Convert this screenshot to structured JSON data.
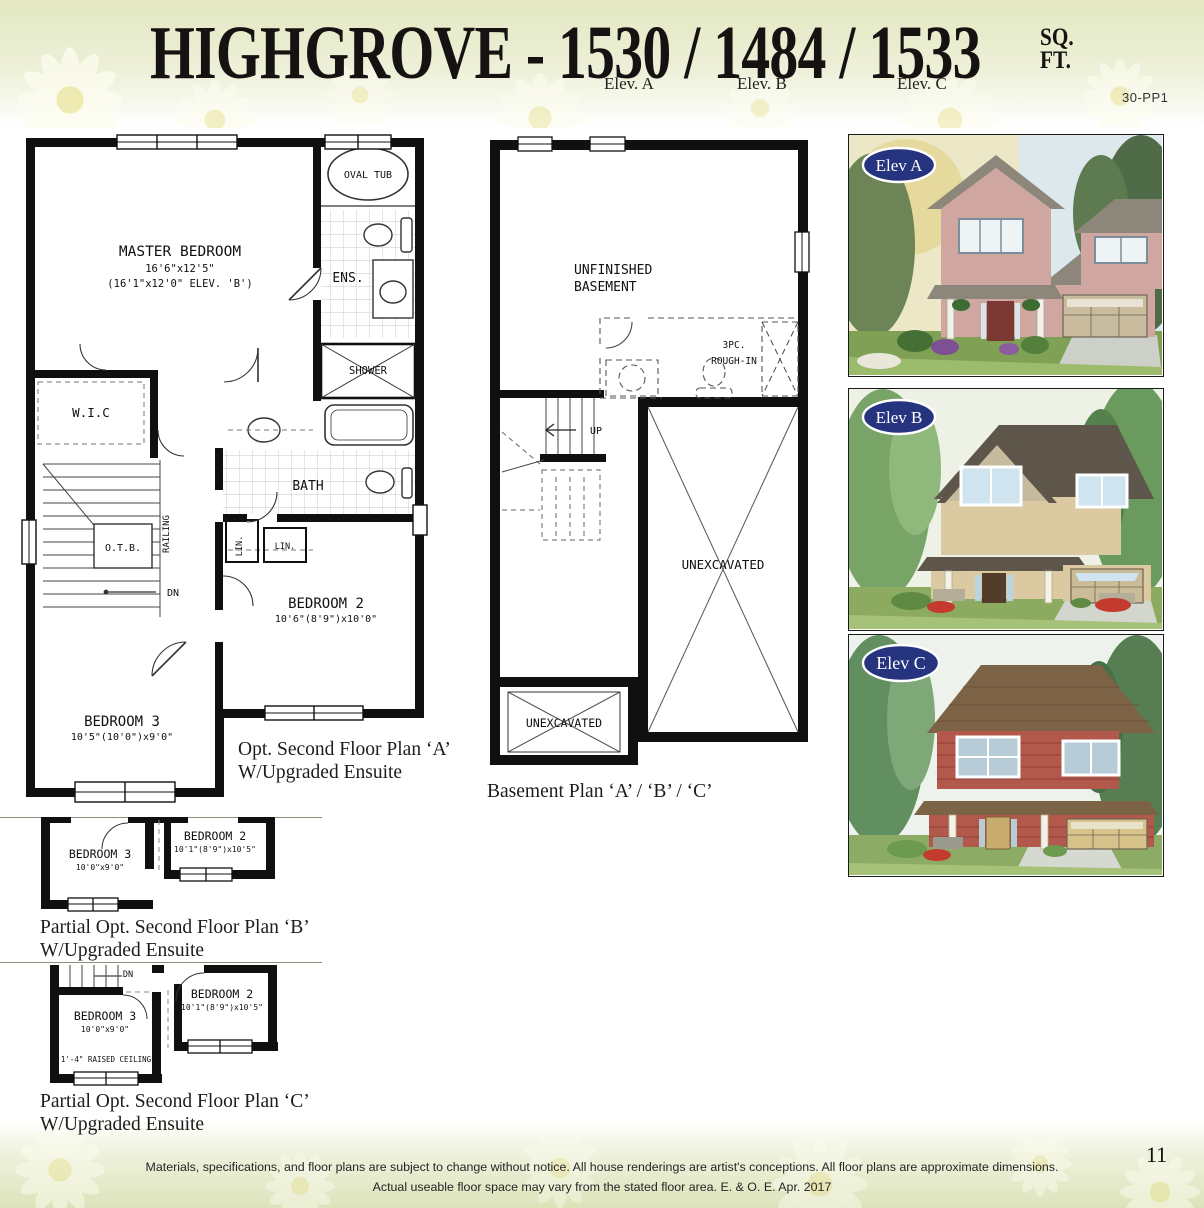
{
  "header": {
    "title": "HIGHGROVE - 1530 / 1484 / 1533",
    "sq": "SQ.",
    "ft": "FT.",
    "elevs": [
      "Elev. A",
      "Elev. B",
      "Elev. C"
    ],
    "code": "30-PP1"
  },
  "plan_a": {
    "caption1": "Opt. Second Floor Plan ‘A’",
    "caption2": "W/Upgraded Ensuite",
    "rooms": {
      "master": {
        "name": "MASTER BEDROOM",
        "dim1": "16'6\"x12'5\"",
        "dim2": "(16'1\"x12'0\" ELEV. 'B')"
      },
      "oval_tub": "OVAL TUB",
      "ens": "ENS.",
      "shower": "SHOWER",
      "wic": "W.I.C",
      "bath": "BATH",
      "otb": "O.T.B.",
      "railing": "RAILING",
      "dn": "DN",
      "lin1": "LIN.",
      "lin2": "LIN.",
      "bedroom2": {
        "name": "BEDROOM 2",
        "dim": "10'6\"(8'9\")x10'0\""
      },
      "bedroom3": {
        "name": "BEDROOM 3",
        "dim": "10'5\"(10'0\")x9'0\""
      }
    }
  },
  "basement": {
    "caption": "Basement Plan ‘A’ / ‘B’ / ‘C’",
    "labels": {
      "unfinished1": "UNFINISHED",
      "unfinished2": "BASEMENT",
      "rough1": "3PC.",
      "rough2": "ROUGH-IN",
      "up": "UP",
      "unexc_right": "UNEXCAVATED",
      "unexc_bottom": "UNEXCAVATED"
    }
  },
  "elevations": [
    {
      "label": "Elev A",
      "colors": {
        "wall": "#cfa6a0",
        "roof": "#8d877b",
        "garage": "#c8bb9e",
        "door": "#7a3a33",
        "oval": "#26337f"
      }
    },
    {
      "label": "Elev B",
      "colors": {
        "wall": "#dbc9a1",
        "roof": "#5e564b",
        "garage": "#cbbc98",
        "door": "#523c2b",
        "oval": "#26337f"
      }
    },
    {
      "label": "Elev C",
      "colors": {
        "wall": "#b2594b",
        "roof": "#7d6345",
        "garage": "#d8c28c",
        "door": "#c8ab6e",
        "oval": "#26337f"
      }
    }
  ],
  "plan_b": {
    "caption1": "Partial Opt. Second Floor Plan ‘B’",
    "caption2": "W/Upgraded Ensuite",
    "bedroom3": {
      "name": "BEDROOM 3",
      "dim": "10'0\"x9'0\""
    },
    "bedroom2": {
      "name": "BEDROOM 2",
      "dim": "10'1\"(8'9\")x10'5\""
    }
  },
  "plan_c": {
    "caption1": "Partial Opt. Second Floor Plan ‘C’",
    "caption2": "W/Upgraded Ensuite",
    "dn": "DN",
    "raised": "1'-4\" RAISED CEILING",
    "bedroom3": {
      "name": "BEDROOM 3",
      "dim": "10'0\"x9'0\""
    },
    "bedroom2": {
      "name": "BEDROOM 2",
      "dim": "10'1\"(8'9\")x10'5\""
    }
  },
  "footer": {
    "line1": "Materials, specifications, and floor plans are subject to change without notice. All house renderings are artist's conceptions. All floor plans are approximate dimensions.",
    "line2": "Actual useable floor space may vary from the stated floor area. E. & O. E. Apr. 2017",
    "page": "11"
  }
}
